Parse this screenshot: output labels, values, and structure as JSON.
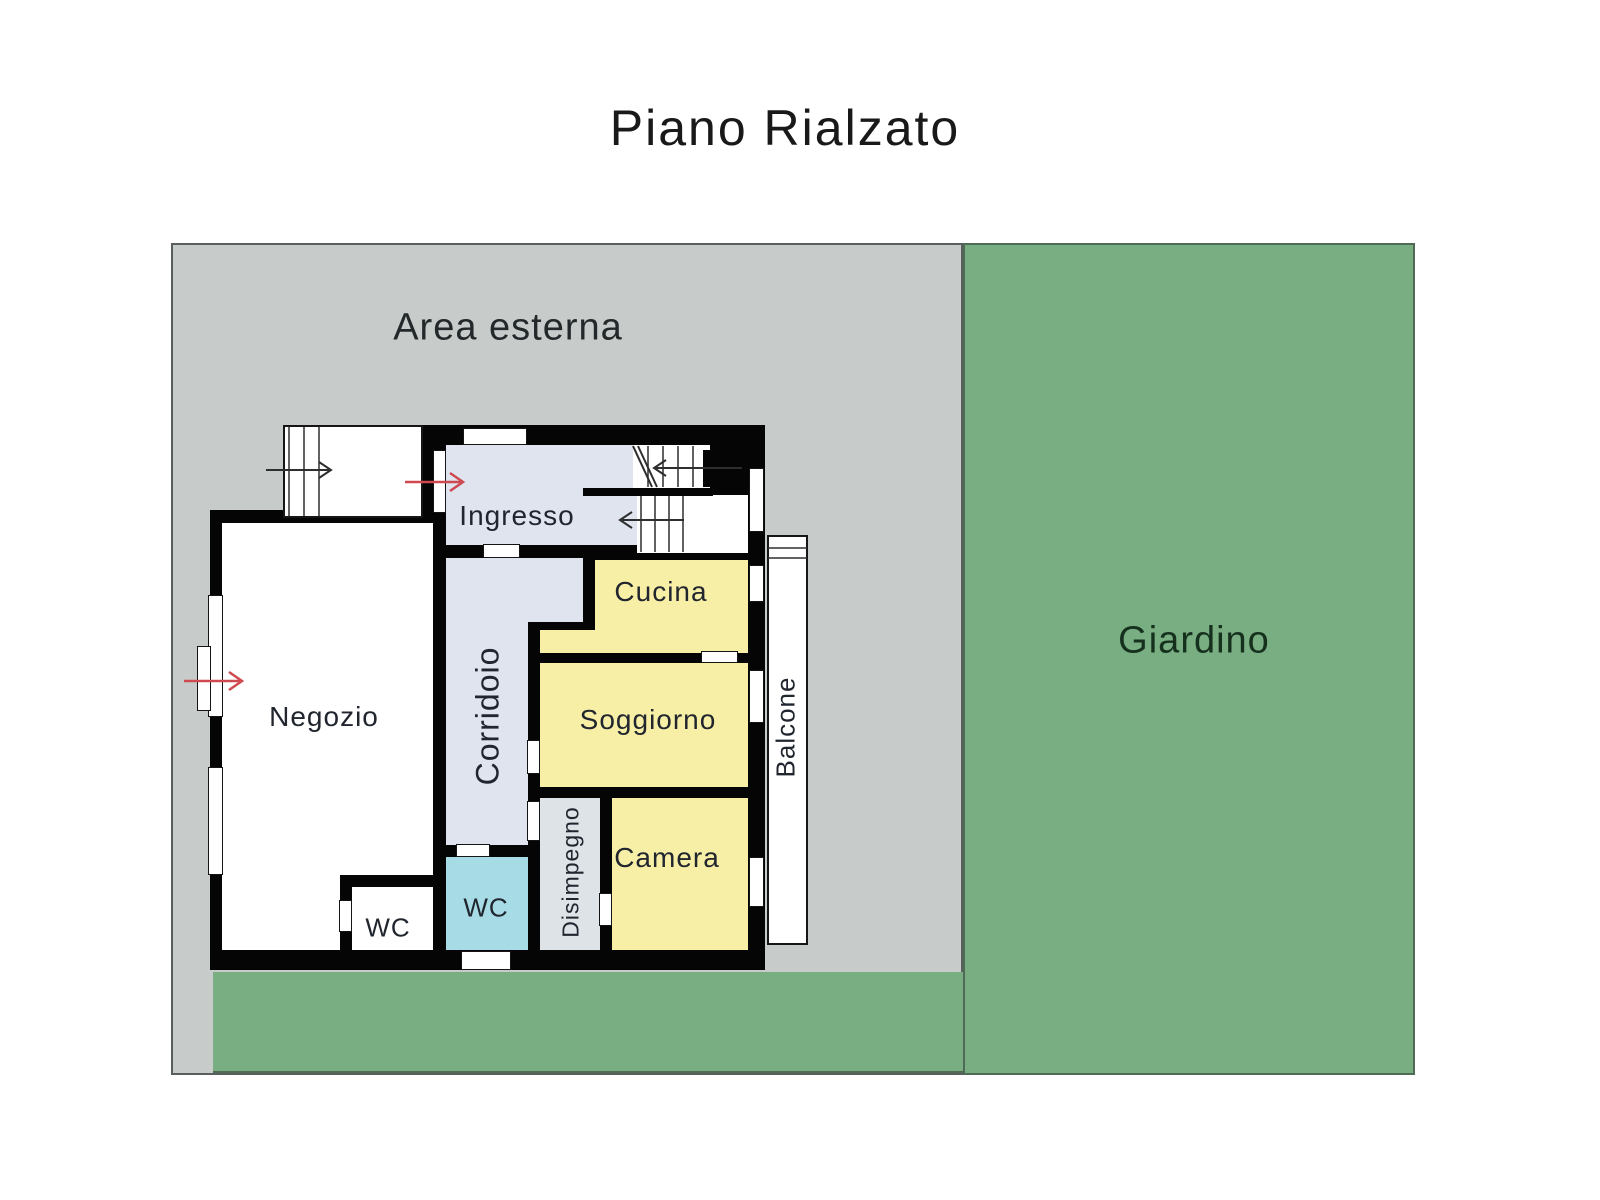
{
  "title": "Piano Rialzato",
  "outdoor": {
    "area_esterna_label": "Area esterna",
    "giardino_label": "Giardino"
  },
  "rooms": {
    "ingresso": {
      "label": "Ingresso"
    },
    "cucina": {
      "label": "Cucina"
    },
    "soggiorno": {
      "label": "Soggiorno"
    },
    "camera": {
      "label": "Camera"
    },
    "negozio": {
      "label": "Negozio"
    },
    "corridoio": {
      "label": "Corridoio"
    },
    "disimpegno": {
      "label": "Disimpegno"
    },
    "wc_main": {
      "label": "WC"
    },
    "wc_shop": {
      "label": "WC"
    },
    "balcone": {
      "label": "Balcone"
    }
  },
  "colors": {
    "outdoor_gray": "#c7ccca",
    "garden_green": "#78ae81",
    "wall_black": "#050505",
    "room_light_blue": "#dfe4ef",
    "room_yellow": "#f8efa7",
    "room_cyan": "#a7dbe6",
    "entrance_arrow_red": "#cf4a50",
    "stair_arrow_gray": "#2e2e2e"
  },
  "icons": {
    "entrance_main": "red-arrow-right",
    "entrance_shop": "red-arrow-right",
    "external_stair_direction": "black-arrow-right",
    "stair_up_direction": "black-arrow-left"
  }
}
